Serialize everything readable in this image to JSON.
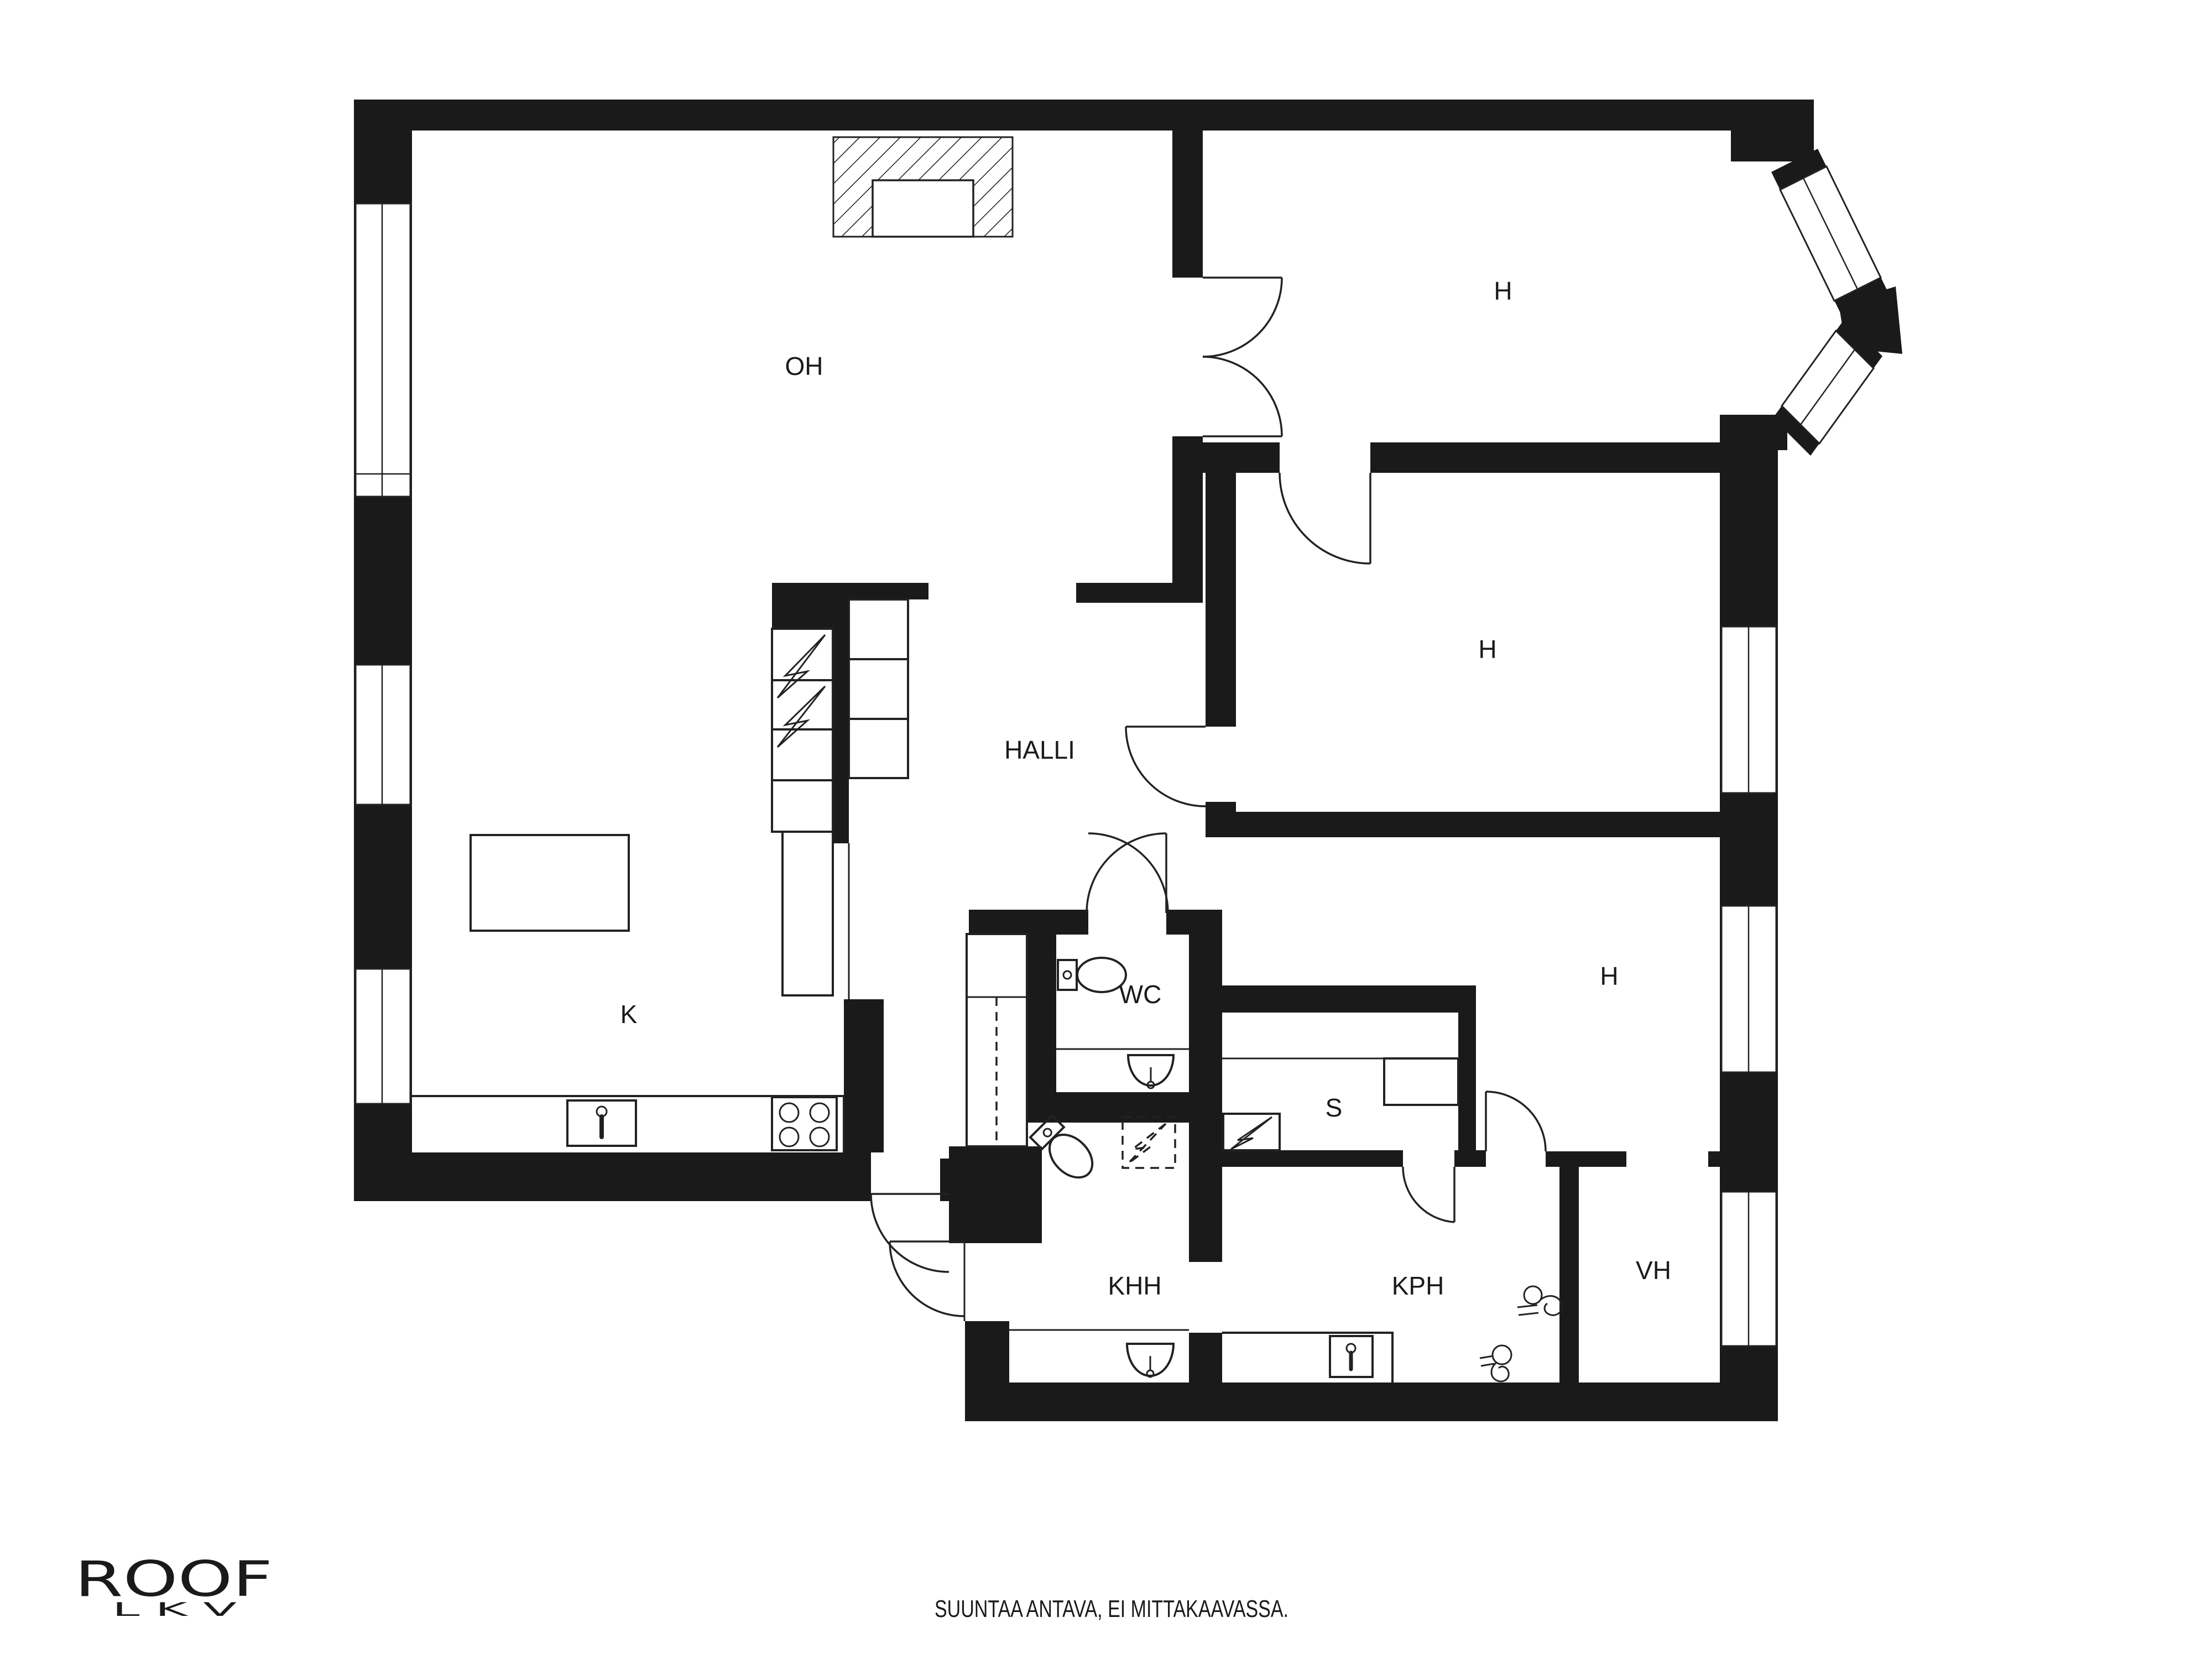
{
  "plan": {
    "labels": {
      "oh": "OH",
      "h_top": "H",
      "h_mid": "H",
      "h_bottom": "H",
      "halli": "HALLI",
      "k": "K",
      "wc": "WC",
      "s": "S",
      "khh": "KHH",
      "kph": "KPH",
      "vh": "VH"
    }
  },
  "branding": {
    "logo_text": "ROOF",
    "logo_sub": "L K V"
  },
  "footer": {
    "note": "SUUNTAA ANTAVA, EI MITTAKAAVASSA."
  },
  "colors": {
    "wall": "#1a1a1a",
    "background": "#ffffff",
    "line": "#222222"
  }
}
